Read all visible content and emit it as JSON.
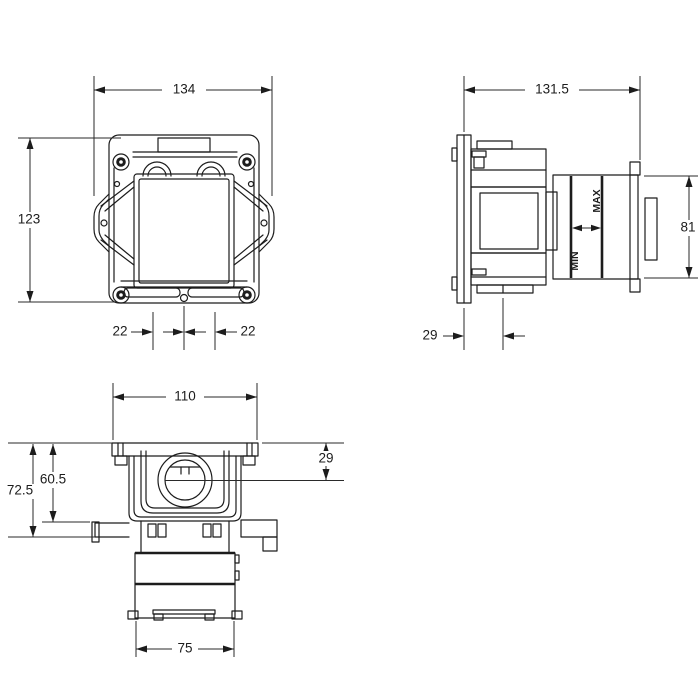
{
  "drawing": {
    "type": "technical-installation-drawing",
    "background": "#ffffff",
    "line_color": "#1c1c1c",
    "views": {
      "front": {
        "name": "front-view",
        "dims": {
          "overall_width": "134",
          "overall_height": "123",
          "offset_left": "22",
          "offset_right": "22"
        }
      },
      "side": {
        "name": "side-view",
        "dims": {
          "overall_depth": "131.5",
          "frame_height": "81",
          "wall_clearance": "29"
        },
        "labels": {
          "min": "MIN",
          "max": "MAX"
        }
      },
      "bottom": {
        "name": "bottom-view",
        "dims": {
          "plate_width": "110",
          "inlet_center_depth": "29",
          "body_depth": "60.5",
          "flange_depth": "72.5",
          "lower_body_width": "75"
        }
      }
    }
  }
}
